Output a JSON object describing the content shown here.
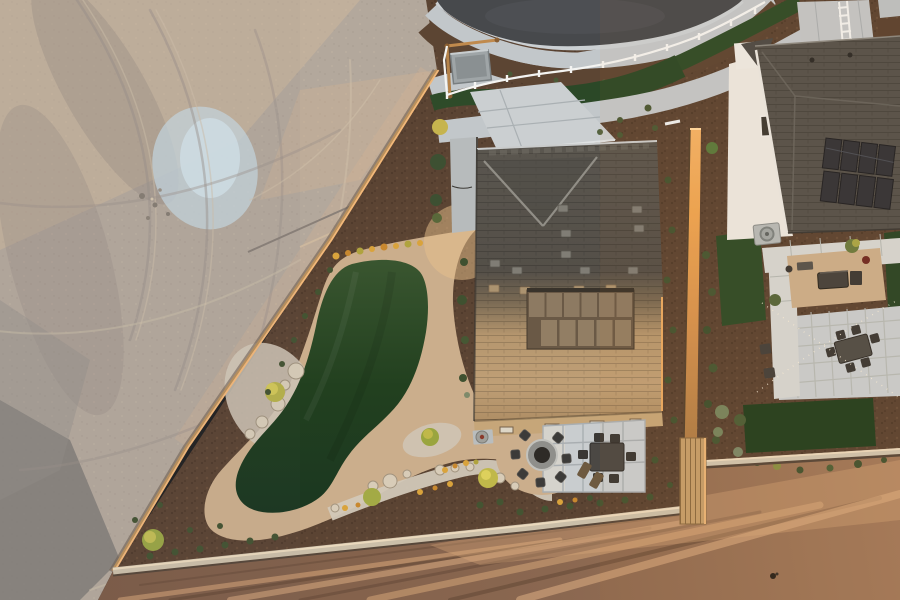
{
  "scene": {
    "title": "Golden-hour aerial drone view of a new-build model home backyard with artificial turf, gravel walking path, fire pit and patio, beside a graded dirt lot and a neighboring white house with solar panels",
    "time_of_day": "sunset golden hour",
    "view": "top-down oblique aerial",
    "regions": [
      {
        "id": "dirt-lot",
        "label": "graded dirt lot with tire tracks"
      },
      {
        "id": "street",
        "label": "cul-de-sac street with curved sidewalks and turf ribbon"
      },
      {
        "id": "main-house",
        "label": "house with dark shingle roof, sunlit rear slope and covered patio"
      },
      {
        "id": "backyard",
        "label": "kidney-shaped artificial turf lawn ringed by decomposed granite path"
      },
      {
        "id": "fire-pit-area",
        "label": "round fire pit with seven chairs on gravel"
      },
      {
        "id": "paver-patio",
        "label": "concrete paver patio with outdoor dining set"
      },
      {
        "id": "neighbor-house",
        "label": "white stucco house with rooftop solar panels"
      },
      {
        "id": "neighbor-yard",
        "label": "neighbor backyard with pavers, turf bands, fire pit and string lights"
      },
      {
        "id": "field",
        "label": "sunlit plowed dirt field"
      },
      {
        "id": "fences",
        "label": "wood property fences catching sunset light"
      }
    ],
    "objects": {
      "houses": 2,
      "fire_pits": 2,
      "fire_pit_chairs": 7,
      "lounge_chairs": 2,
      "dining_chairs_main": 6,
      "dining_chairs_neighbor": 6,
      "solar_panels": 8,
      "boulders": 14,
      "utility_box": 1,
      "ac_unit": 1
    }
  },
  "colors": {
    "dirt_lot": "#b3a89c",
    "dirt_highlight": "#d8bb9e",
    "dirt_shadow": "#938980",
    "blue_patch": "#c6d6de",
    "asphalt": "#47494c",
    "concrete": "#c2c7ca",
    "curb": "#cbd0d3",
    "mulch": "#5b4433",
    "turf": "#2e4b29",
    "turf_dark": "#1f3b20",
    "decomposed_granite": "#cbae8c",
    "gravel_light": "#d2c8b8",
    "boulder": "#d8ccb8",
    "roof_dark": "#55524c",
    "roof_sunlit": "#bd9c72",
    "patio_cover": "#6a5946",
    "patio_panel": "#8d7a62",
    "wall_tan": "#c6a679",
    "white_wall": "#ebe8e2",
    "solar_panel": "#323338",
    "paver": "#c9cdcf",
    "furniture": "#3c3b39",
    "firepit_ring": "#8f8f8b",
    "fence_wood": "#b9905c",
    "fence_lit": "#f2b879",
    "fence_plank": "#c59e6b",
    "field_dirt": "#8a6750",
    "field_lit": "#d9a87a",
    "flower_yellow": "#d9a33c",
    "shrub_green": "#445432",
    "white_rail": "#f4f4f2",
    "string_light": "#f7eedb"
  }
}
